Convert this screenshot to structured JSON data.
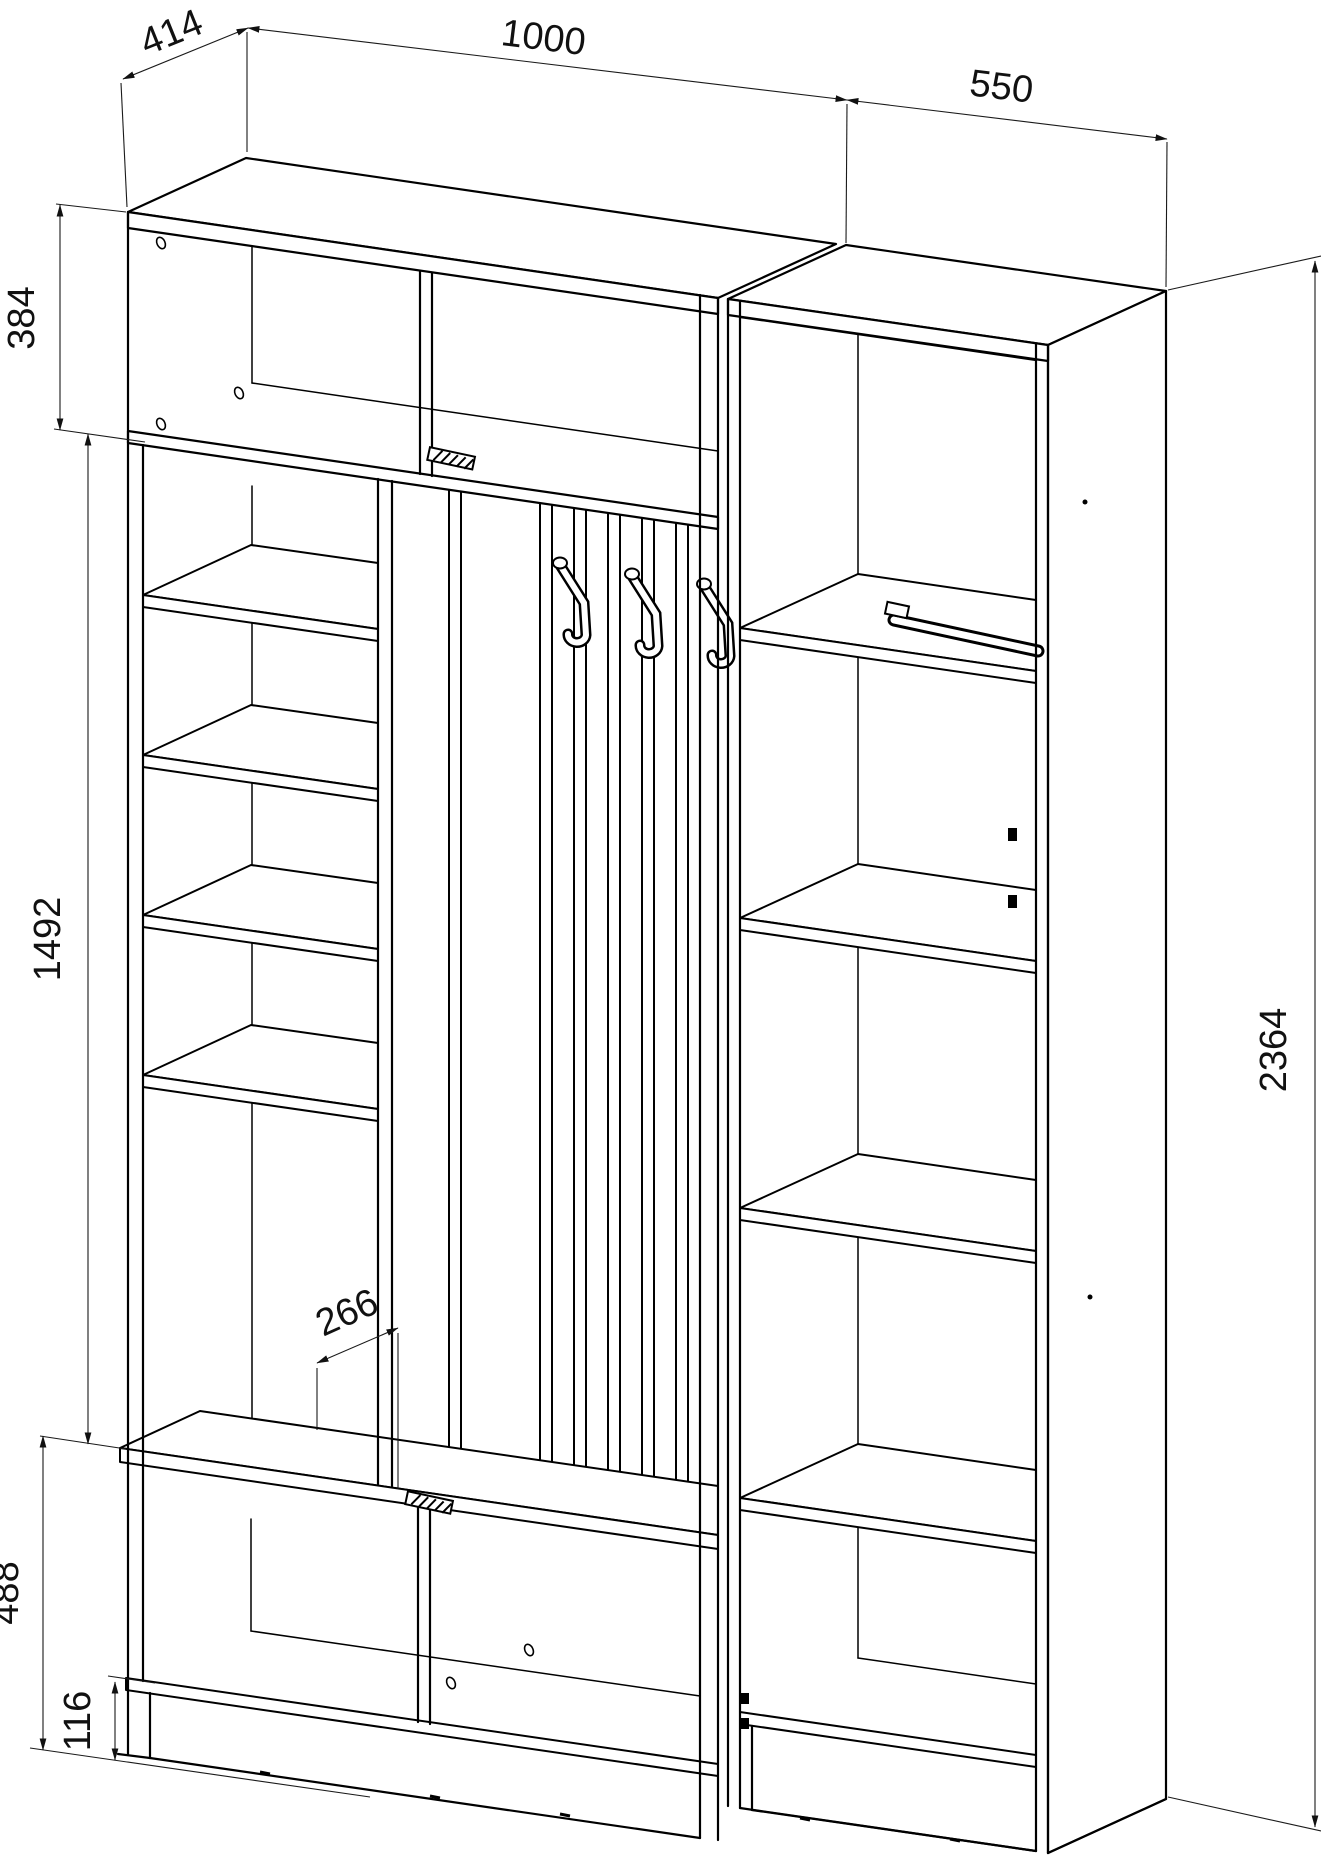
{
  "drawing": {
    "kind": "axonometric furniture assembly drawing",
    "subject": "hallway wardrobe unit with coat-hook panel, shelving column, bench cabinet and side wardrobe"
  },
  "dimensions": {
    "depth": "414",
    "left_section_width": "1000",
    "right_section_width": "550",
    "upper_cabinet_height": "384",
    "open_section_height": "1492",
    "total_height": "2364",
    "bench_depth": "266",
    "lower_cabinet_height": "488",
    "plinth_height": "116"
  }
}
